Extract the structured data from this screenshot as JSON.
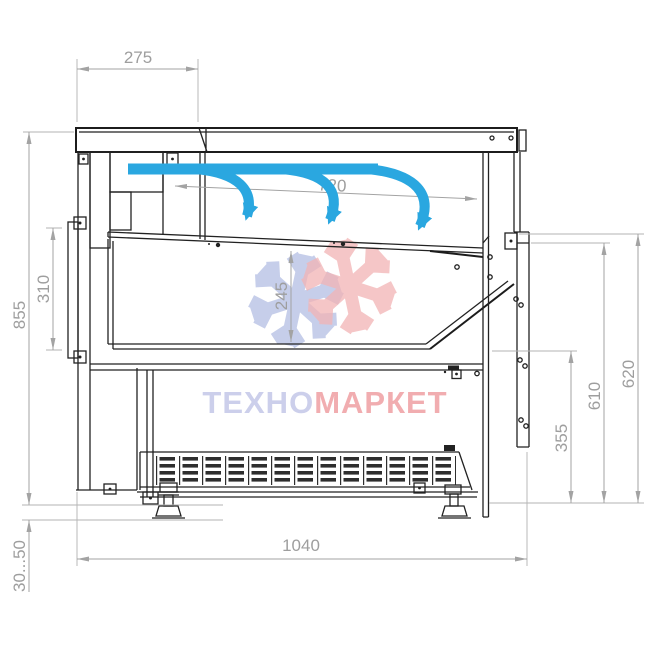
{
  "dimensions": {
    "canopy_depth": "275",
    "opening_width": "720",
    "well_depth": "245",
    "rear_panel_height": "310",
    "rear_height": "855",
    "foot_height_range": "30...50",
    "overall_depth": "1040",
    "front_lower_height": "355",
    "front_mid_height": "610",
    "front_height": "620"
  },
  "watermark": {
    "brand_prefix": "ТЕХНО",
    "brand_suffix": "МАРКЕТ"
  },
  "colors": {
    "structure_line": "#222222",
    "dimension_gray": "#9e9e9e",
    "airflow_blue": "#2aa7e0",
    "watermark_blue": "#bdc6e7",
    "watermark_red": "#f2b4b5",
    "brand_blue": "#c7cae9",
    "brand_red": "#f0a5a8"
  }
}
